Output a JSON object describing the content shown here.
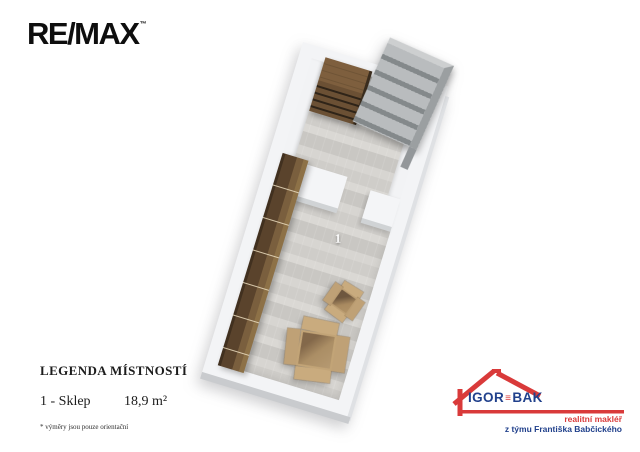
{
  "remax": {
    "wordmark": "RE/MAX",
    "trademark": "™",
    "color": "#0e0e0e"
  },
  "plan": {
    "room_label": "1",
    "furniture": [
      "drawer-chest",
      "metal-shelving",
      "wood-shelving",
      "cardboard-box-small",
      "cardboard-box-large"
    ],
    "colors": {
      "wall": "#f3f4f6",
      "wall_side": "#c9cbce",
      "floor": "#d3d1cd",
      "wood_dark": "#4b3826",
      "wood_mid": "#6f5539",
      "cardboard": "#c6a87c",
      "shelf_gray": "#aeb2b4"
    }
  },
  "legend": {
    "title": "LEGENDA MÍSTNOSTÍ",
    "rows": [
      {
        "label": "1 - Sklep",
        "area": "18,9 m²"
      }
    ],
    "footnote": "* výměry jsou pouze orientační"
  },
  "agency": {
    "name_first": "IGOR",
    "separator": "≡",
    "name_second": "BAK",
    "tagline_red": "realitní makléř",
    "tagline_blue": "z týmu Františka Babčického",
    "red": "#d93a3a",
    "blue": "#21418c"
  }
}
